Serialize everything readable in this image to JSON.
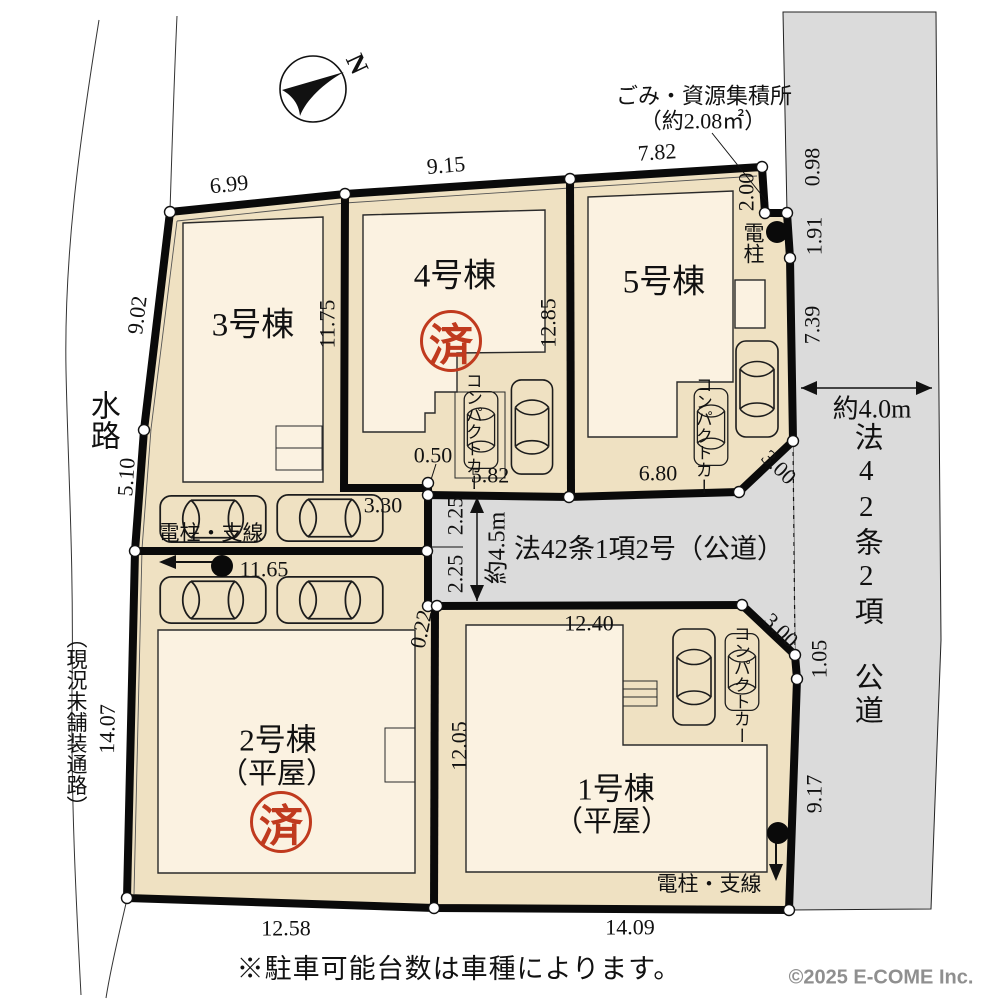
{
  "compass": {
    "north": "N"
  },
  "labels": {
    "waterway": "水路",
    "unpaved": "（現況未舗装通路）",
    "garbage_title": "ごみ・資源集積所",
    "garbage_area": "（約2.08㎡）",
    "pole": "電柱",
    "pole_wire_west": "電柱・支線",
    "pole_wire_south": "電柱・支線",
    "compact_car": "コンパクトカー",
    "note": "※駐車可能台数は車種によります。",
    "copyright": "©2025  E-COME Inc."
  },
  "roads": {
    "east_name": "法42条2項　公道",
    "east_width": "約4.0m",
    "center_name": "法42条1項2号（公道）",
    "center_width": "約4.5m"
  },
  "buildings": {
    "b1": {
      "name": "1号棟",
      "type": "（平屋）"
    },
    "b2": {
      "name": "2号棟",
      "type": "（平屋）",
      "stamp": "済"
    },
    "b3": {
      "name": "3号棟"
    },
    "b4": {
      "name": "4号棟",
      "stamp": "済"
    },
    "b5": {
      "name": "5号棟"
    }
  },
  "dims": {
    "d699": "6.99",
    "d915": "9.15",
    "d782": "7.82",
    "d098": "0.98",
    "d191": "1.91",
    "d200": "2.00",
    "d739": "7.39",
    "d902": "9.02",
    "d510": "5.10",
    "d1407": "14.07",
    "d1175": "11.75",
    "d1285": "12.85",
    "d050": "0.50",
    "d582": "5.82",
    "d330": "3.30",
    "d680": "6.80",
    "d300ne": "3.00",
    "d300se": "3.00",
    "d225a": "2.25",
    "d225b": "2.25",
    "d1165": "11.65",
    "d022": "0.22",
    "d1240": "12.40",
    "d1205": "12.05",
    "d105": "1.05",
    "d917": "9.17",
    "d1258": "12.58",
    "d1409": "14.09"
  }
}
